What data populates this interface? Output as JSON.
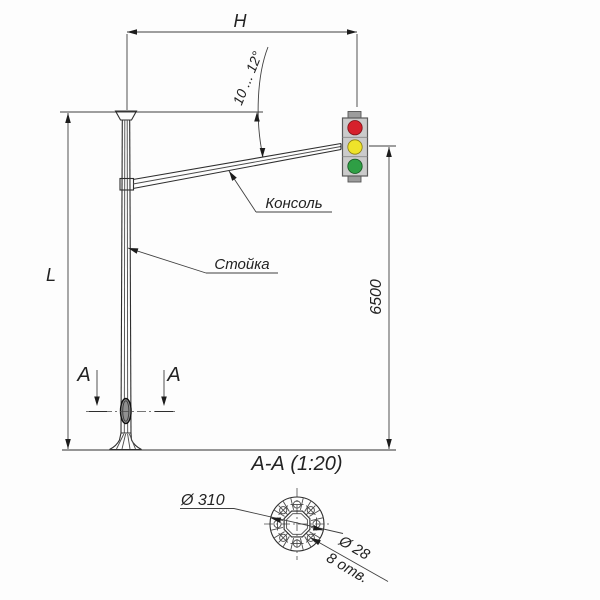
{
  "drawing": {
    "dims": {
      "h": "H",
      "l": "L",
      "height": "6500",
      "angle": "10 ... 12°"
    },
    "callouts": {
      "console": "Консоль",
      "post": "Стойка"
    },
    "section": {
      "marker": "А",
      "title": "А-А  (1:20)",
      "flange_dia": "Ø 310",
      "hole_dia": "Ø 28",
      "hole_count": "8 отв."
    },
    "traffic_light": {
      "colors": {
        "red": "#d6202b",
        "yellow": "#efe32a",
        "green": "#2f9f45",
        "body": "#cbcbcb",
        "tab": "#9c9c9c"
      }
    },
    "line_color": "#2e2e2e"
  }
}
